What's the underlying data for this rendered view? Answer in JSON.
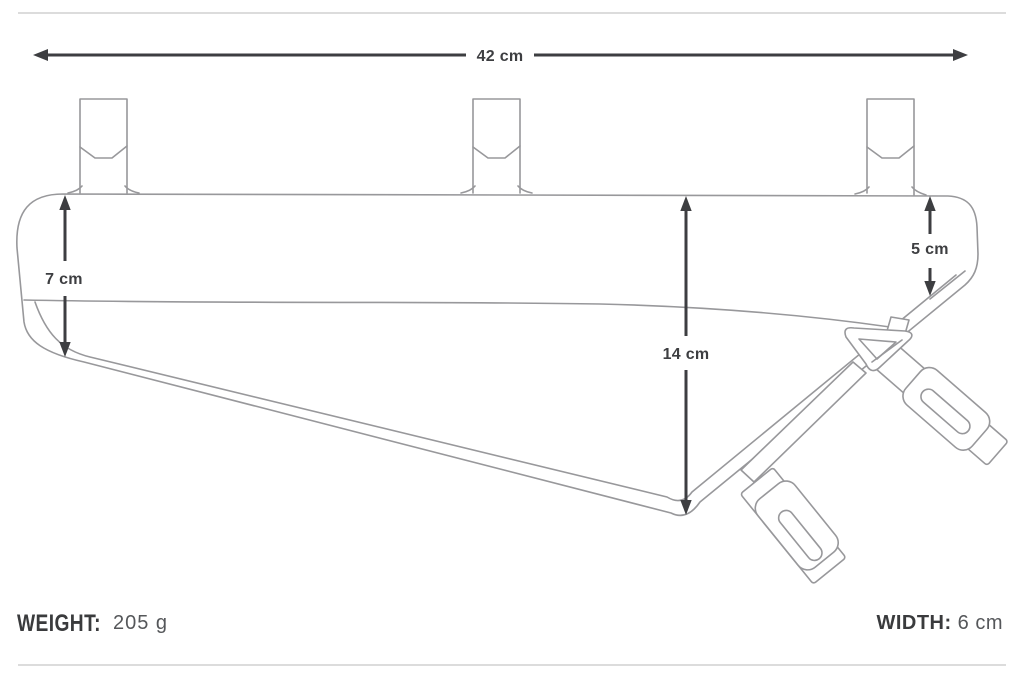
{
  "colors": {
    "bg": "#ffffff",
    "outline": "#98989b",
    "dim": "#3d3e41",
    "rule": "#dcdcdc",
    "label": "#3a3b3d",
    "value": "#55575a"
  },
  "dimensions": {
    "top_width": "42 cm",
    "left_height": "7 cm",
    "middle_height": "14 cm",
    "right_height": "5 cm"
  },
  "footer": {
    "weight_label": "WEIGHT:",
    "weight_value": "205 g",
    "width_label": "WIDTH:",
    "width_value": "6 cm"
  }
}
